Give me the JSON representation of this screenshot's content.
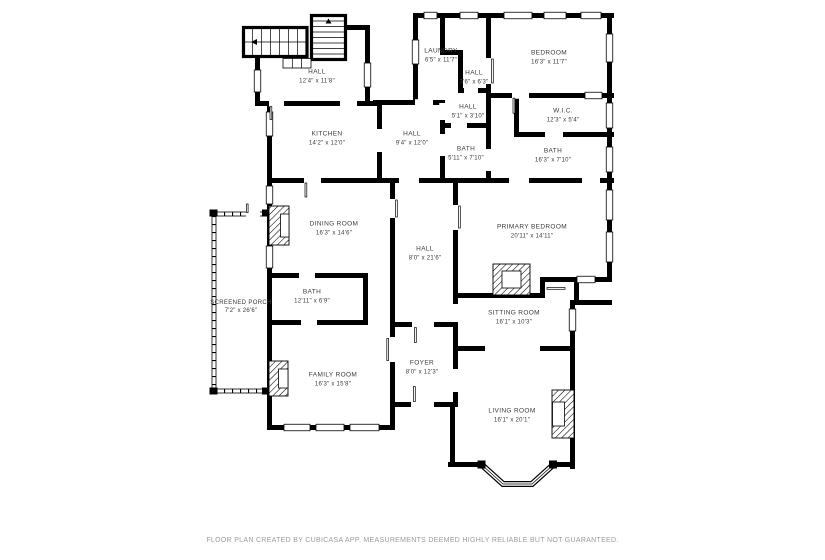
{
  "colors": {
    "wall": "#000000",
    "background": "#ffffff",
    "label_text": "#3a3a3a",
    "footer_text": "#9b9b9b"
  },
  "rooms": [
    {
      "name": "HALL",
      "dims": "12'4\" x 11'8\""
    },
    {
      "name": "LAUNDRY",
      "dims": "6'5\" x 11'7\""
    },
    {
      "name": "HALL",
      "dims": "3'6\" x 6'3\""
    },
    {
      "name": "BEDROOM",
      "dims": "16'3\" x 11'7\""
    },
    {
      "name": "HALL",
      "dims": "5'1\" x 3'10\""
    },
    {
      "name": "KITCHEN",
      "dims": "14'2\" x 12'0\""
    },
    {
      "name": "HALL",
      "dims": "9'4\" x 12'0\""
    },
    {
      "name": "BATH",
      "dims": "5'11\" x 7'10\""
    },
    {
      "name": "W.I.C.",
      "dims": "12'3\" x 5'4\""
    },
    {
      "name": "BATH",
      "dims": "16'3\" x 7'10\""
    },
    {
      "name": "DINING ROOM",
      "dims": "16'3\" x 14'6\""
    },
    {
      "name": "HALL",
      "dims": "8'0\" x 21'6\""
    },
    {
      "name": "PRIMARY BEDROOM",
      "dims": "20'11\" x 14'11\""
    },
    {
      "name": "SCREENED PORCH",
      "dims": "7'2\" x 26'6\""
    },
    {
      "name": "BATH",
      "dims": "12'11\" x 6'9\""
    },
    {
      "name": "FAMILY ROOM",
      "dims": "16'3\" x 15'8\""
    },
    {
      "name": "SITTING ROOM",
      "dims": "16'1\" x 10'3\""
    },
    {
      "name": "FOYER",
      "dims": "8'0\" x 12'3\""
    },
    {
      "name": "LIVING ROOM",
      "dims": "16'1\" x 20'1\""
    }
  ],
  "footer": {
    "disclaimer": "FLOOR PLAN CREATED BY CUBICASA APP. MEASUREMENTS DEEMED HIGHLY RELIABLE BUT NOT GUARANTEED."
  }
}
